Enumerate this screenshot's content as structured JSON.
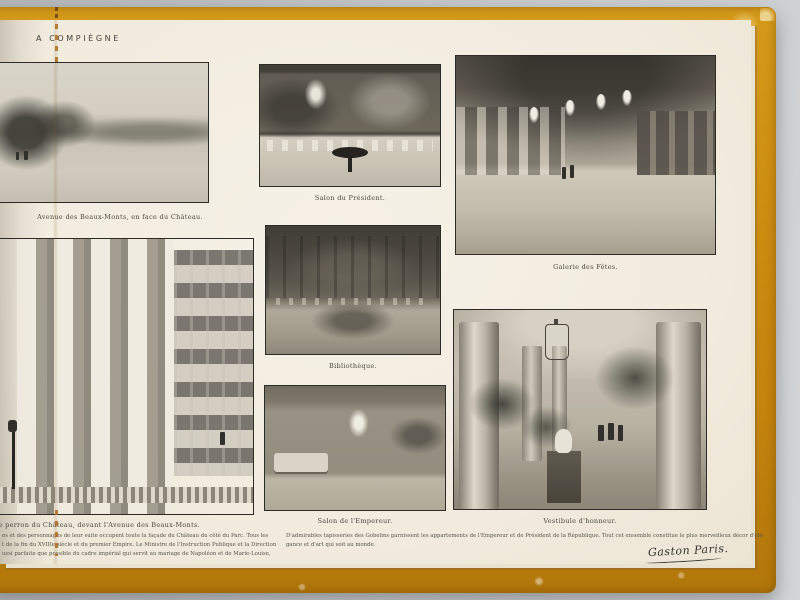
{
  "book": {
    "title_header": "A COMPIÈGNE",
    "photos": [
      {
        "name": "avenue-des-beaux-monts",
        "caption": "Avenue des Beaux-Monts, en face du Château."
      },
      {
        "name": "salon-du-president",
        "caption": "Salon du Président."
      },
      {
        "name": "galerie-des-fetes",
        "caption": "Galerie des Fêtes."
      },
      {
        "name": "bibliotheque",
        "caption": "Bibliothèque."
      },
      {
        "name": "salon-de-l-empereur",
        "caption": "Salon de l'Empereur."
      },
      {
        "name": "vestibule-d-honneur",
        "caption": "Vestibule d'honneur."
      },
      {
        "name": "perron-du-chateau",
        "caption": "Le perron du Château, devant l'Avenue des Beaux-Monts."
      }
    ],
    "left_column_text": {
      "line1": "es et des personnages de leur suite occupent toute la façade du Château du côté du Parc. Tous les",
      "line2": "t de la fin du XVIIIe siècle et du premier Empire. Le Ministre de l'Instruction Publique et la Direction",
      "line3": "ussi parfaite que possible du cadre impérial qui servit au mariage de Napoléon et de Marie-Louise,"
    },
    "footer_text": {
      "line1": "D'admirables tapisseries des Gobelins garnissent les appartements de l'Empereur et de Président de la République. Tout cet ensemble constitue le plus merveilleux décor d'élé-",
      "line2": "gance et d'art qui soit au monde."
    },
    "signature": "Gaston Paris."
  },
  "colors": {
    "background": "#c6c9cb",
    "cover": "#cd8d11",
    "page": "#f3eee3",
    "ink": "#4b4840"
  }
}
